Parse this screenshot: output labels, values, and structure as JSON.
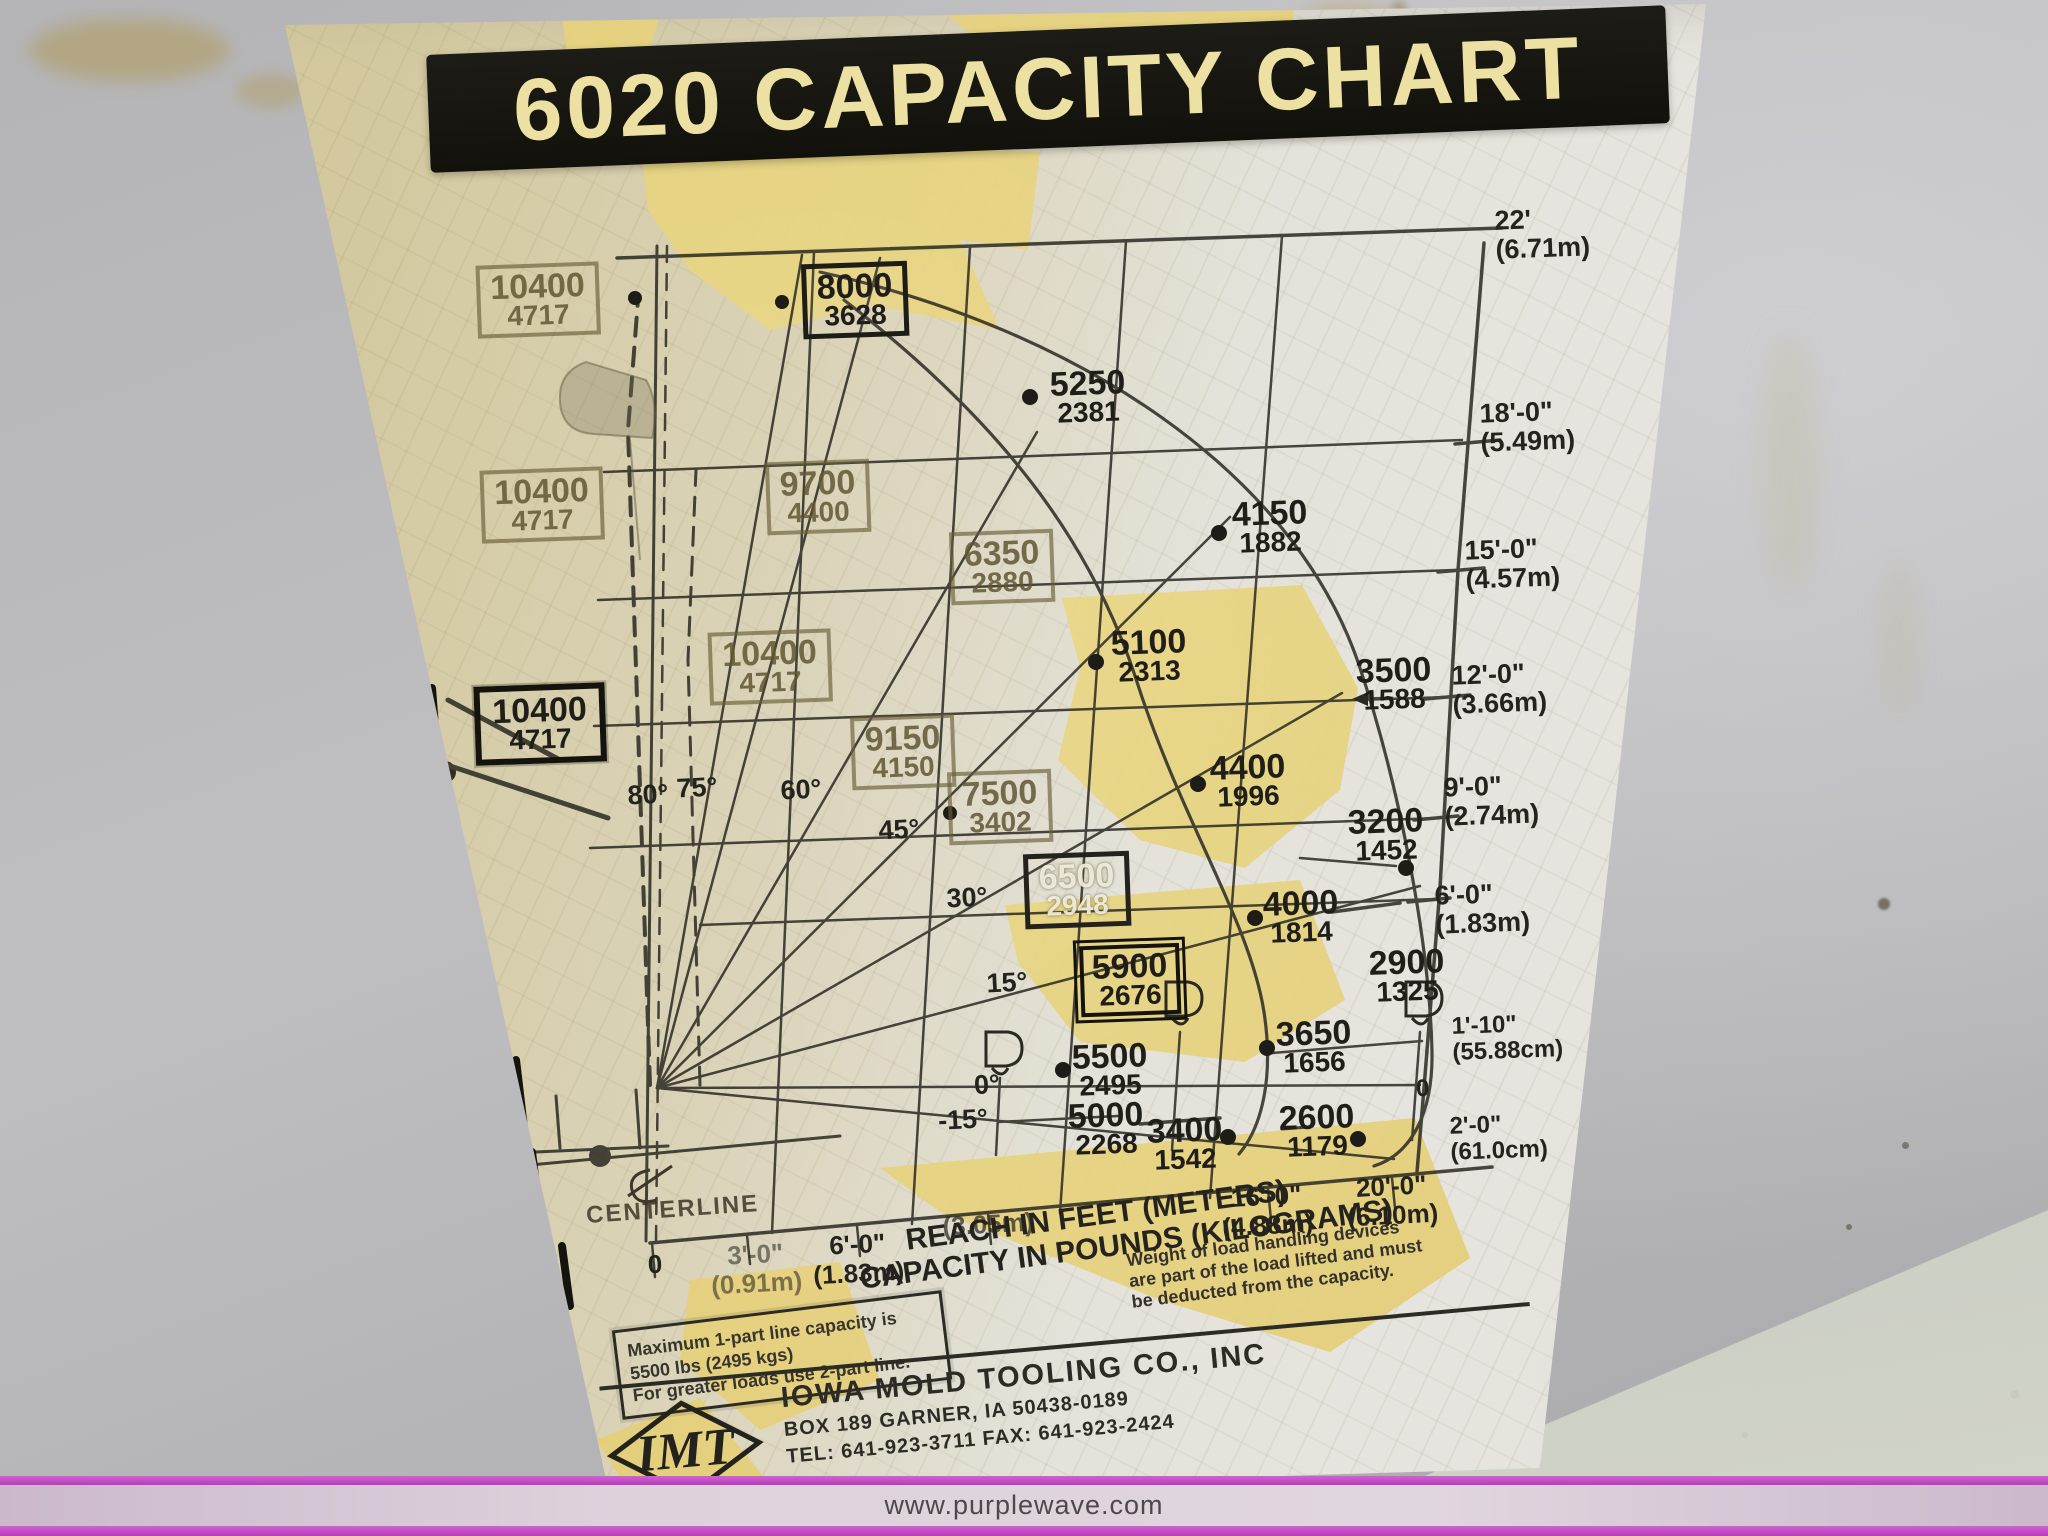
{
  "photo": {
    "watermark": "www.purplewave.com",
    "accent_color": "#c44dc6"
  },
  "sticker": {
    "title_color": "#ece0a2",
    "banner_color": "#14130e",
    "notes": {
      "weight_lines": [
        "Weight of load handling devices",
        "are part of the load lifted and must",
        "be deducted from the capacity."
      ],
      "max_lines": [
        "Maximum 1-part line capacity is",
        "5500 lbs (2495 kgs)",
        "For greater loads use 2-part line."
      ]
    },
    "footer": {
      "brand": "IMT",
      "company": "IOWA MOLD TOOLING CO., INC",
      "address": "BOX 189  GARNER, IA 50438-0189",
      "phone": "TEL: 641-923-3711    FAX: 641-923-2424"
    }
  },
  "chart_data": {
    "type": "scatter",
    "title": "6020 CAPACITY CHART",
    "xlabel": "REACH IN FEET (METERS)",
    "ylabel": "CAPACITY IN POUNDS (KILOGRAMS)",
    "centerline": "CENTERLINE",
    "legend_position": "none",
    "grid": true,
    "reach_ticks": [
      {
        "ft": "0",
        "m": ""
      },
      {
        "ft": "3'-0\"",
        "m": "(0.91m)"
      },
      {
        "ft": "6'-0\"",
        "m": "(1.83m)"
      },
      {
        "ft": "",
        "m": "(3.05m)"
      },
      {
        "ft": "16'-0\"",
        "m": "(4.88m)"
      },
      {
        "ft": "20'-0\"",
        "m": "(6.10m)"
      }
    ],
    "height_ticks": [
      {
        "ft": "22'",
        "m": "(6.71m)"
      },
      {
        "ft": "18'-0\"",
        "m": "(5.49m)"
      },
      {
        "ft": "15'-0\"",
        "m": "(4.57m)"
      },
      {
        "ft": "12'-0\"",
        "m": "(3.66m)"
      },
      {
        "ft": "9'-0\"",
        "m": "(2.74m)"
      },
      {
        "ft": "6'-0\"",
        "m": "(1.83m)"
      },
      {
        "ft": "1'-10\"",
        "m": "(55.88cm)"
      },
      {
        "ft": "0",
        "m": ""
      },
      {
        "ft": "2'-0\"",
        "m": "(61.0cm)"
      }
    ],
    "boom_angles": [
      "80°",
      "75°",
      "60°",
      "45°",
      "30°",
      "15°",
      "0°",
      "-15°"
    ],
    "points": [
      {
        "lbs": "10400",
        "kg": "4717"
      },
      {
        "lbs": "8000",
        "kg": "3628"
      },
      {
        "lbs": "5250",
        "kg": "2381"
      },
      {
        "lbs": "10400",
        "kg": "4717"
      },
      {
        "lbs": "9700",
        "kg": "4400"
      },
      {
        "lbs": "6350",
        "kg": "2880"
      },
      {
        "lbs": "4150",
        "kg": "1882"
      },
      {
        "lbs": "10400",
        "kg": "4717"
      },
      {
        "lbs": "10400",
        "kg": "4717"
      },
      {
        "lbs": "9150",
        "kg": "4150"
      },
      {
        "lbs": "5100",
        "kg": "2313"
      },
      {
        "lbs": "3500",
        "kg": "1588"
      },
      {
        "lbs": "7500",
        "kg": "3402"
      },
      {
        "lbs": "4400",
        "kg": "1996"
      },
      {
        "lbs": "3200",
        "kg": "1452"
      },
      {
        "lbs": "6500",
        "kg": "2948"
      },
      {
        "lbs": "4000",
        "kg": "1814"
      },
      {
        "lbs": "5900",
        "kg": "2676"
      },
      {
        "lbs": "2900",
        "kg": "1325"
      },
      {
        "lbs": "5500",
        "kg": "2495"
      },
      {
        "lbs": "3650",
        "kg": "1656"
      },
      {
        "lbs": "5000",
        "kg": "2268"
      },
      {
        "lbs": "3400",
        "kg": "1542"
      },
      {
        "lbs": "2600",
        "kg": "1179"
      }
    ]
  }
}
